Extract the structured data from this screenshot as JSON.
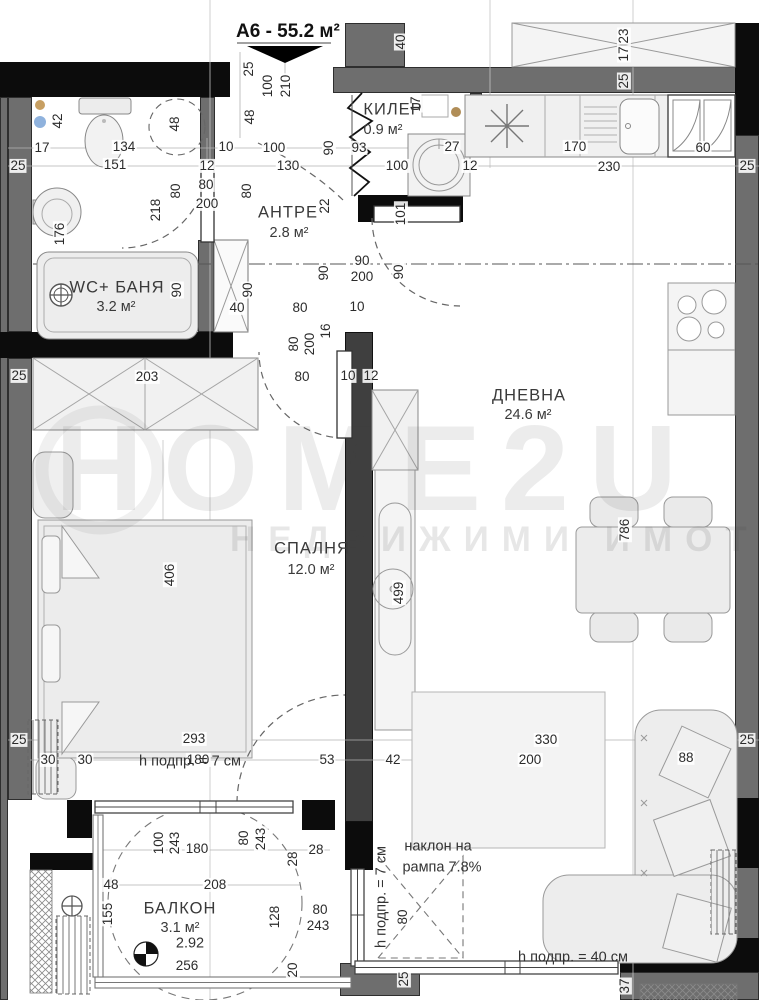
{
  "title": {
    "unit": "А6 - 55.2 м²"
  },
  "watermark": {
    "brand": "HOME2U",
    "tagline": "НЕДВИЖИМИ ИМОТИ"
  },
  "rooms": [
    {
      "name": "КИЛЕР",
      "area": "0.9 м²",
      "x": 393,
      "y": 110,
      "ax": 383,
      "ay": 130
    },
    {
      "name": "АНТРЕ",
      "area": "2.8 м²",
      "x": 288,
      "y": 213,
      "ax": 289,
      "ay": 233
    },
    {
      "name": "WC+ БАНЯ",
      "area": "3.2 м²",
      "x": 117,
      "y": 288,
      "ax": 116,
      "ay": 307
    },
    {
      "name": "ДНЕВНА",
      "area": "24.6 м²",
      "x": 529,
      "y": 396,
      "ax": 528,
      "ay": 415
    },
    {
      "name": "СПАЛНЯ",
      "area": "12.0 м²",
      "x": 312,
      "y": 549,
      "ax": 311,
      "ay": 570
    },
    {
      "name": "БАЛКОН",
      "area": "3.1 м²",
      "x": 180,
      "y": 909,
      "ax": 180,
      "ay": 928
    }
  ],
  "annotations": [
    {
      "t": "h подпр. = 7 см",
      "x": 190,
      "y": 762
    },
    {
      "t": "h подпр. = 7 см",
      "x": 382,
      "y": 897,
      "r": 1
    },
    {
      "t": "наклон на",
      "x": 438,
      "y": 847
    },
    {
      "t": "рампа 7.8%",
      "x": 442,
      "y": 868
    },
    {
      "t": "h подпр. = 40 см",
      "x": 573,
      "y": 958
    },
    {
      "t": "2.92",
      "x": 190,
      "y": 944
    }
  ],
  "dimensions": [
    {
      "t": "25",
      "x": 249,
      "y": 69,
      "r": 1
    },
    {
      "t": "100",
      "x": 268,
      "y": 86,
      "r": 1
    },
    {
      "t": "210",
      "x": 286,
      "y": 86,
      "r": 1
    },
    {
      "t": "48",
      "x": 250,
      "y": 117,
      "r": 1
    },
    {
      "t": "40",
      "x": 401,
      "y": 42,
      "r": 1
    },
    {
      "t": "23",
      "x": 624,
      "y": 36,
      "r": 1
    },
    {
      "t": "17",
      "x": 624,
      "y": 54,
      "r": 1
    },
    {
      "t": "25",
      "x": 624,
      "y": 81,
      "r": 1
    },
    {
      "t": "42",
      "x": 58,
      "y": 121,
      "r": 1
    },
    {
      "t": "17",
      "x": 42,
      "y": 148
    },
    {
      "t": "134",
      "x": 124,
      "y": 147
    },
    {
      "t": "151",
      "x": 115,
      "y": 165
    },
    {
      "t": "48",
      "x": 175,
      "y": 124,
      "r": 1
    },
    {
      "t": "25",
      "x": 18,
      "y": 166
    },
    {
      "t": "10",
      "x": 226,
      "y": 147
    },
    {
      "t": "100",
      "x": 274,
      "y": 148
    },
    {
      "t": "90",
      "x": 329,
      "y": 148,
      "r": 1
    },
    {
      "t": "93",
      "x": 359,
      "y": 148
    },
    {
      "t": "130",
      "x": 288,
      "y": 166
    },
    {
      "t": "100",
      "x": 397,
      "y": 166
    },
    {
      "t": "17",
      "x": 416,
      "y": 104,
      "r": 1
    },
    {
      "t": "27",
      "x": 452,
      "y": 147
    },
    {
      "t": "12",
      "x": 470,
      "y": 166
    },
    {
      "t": "170",
      "x": 575,
      "y": 147
    },
    {
      "t": "230",
      "x": 609,
      "y": 167
    },
    {
      "t": "60",
      "x": 703,
      "y": 148
    },
    {
      "t": "25",
      "x": 747,
      "y": 166
    },
    {
      "t": "80",
      "x": 247,
      "y": 191,
      "r": 1
    },
    {
      "t": "12",
      "x": 207,
      "y": 166
    },
    {
      "t": "80",
      "x": 206,
      "y": 185
    },
    {
      "t": "200",
      "x": 207,
      "y": 204
    },
    {
      "t": "80",
      "x": 176,
      "y": 191,
      "r": 1
    },
    {
      "t": "218",
      "x": 156,
      "y": 210,
      "r": 1
    },
    {
      "t": "176",
      "x": 60,
      "y": 234,
      "r": 1
    },
    {
      "t": "22",
      "x": 325,
      "y": 206,
      "r": 1
    },
    {
      "t": "101",
      "x": 401,
      "y": 214,
      "r": 1
    },
    {
      "t": "90",
      "x": 177,
      "y": 290,
      "r": 1
    },
    {
      "t": "90",
      "x": 248,
      "y": 290,
      "r": 1
    },
    {
      "t": "40",
      "x": 237,
      "y": 308
    },
    {
      "t": "90",
      "x": 324,
      "y": 273,
      "r": 1
    },
    {
      "t": "90",
      "x": 362,
      "y": 261
    },
    {
      "t": "200",
      "x": 362,
      "y": 277
    },
    {
      "t": "90",
      "x": 399,
      "y": 272,
      "r": 1
    },
    {
      "t": "80",
      "x": 300,
      "y": 308
    },
    {
      "t": "10",
      "x": 357,
      "y": 307
    },
    {
      "t": "80",
      "x": 294,
      "y": 344,
      "r": 1
    },
    {
      "t": "200",
      "x": 310,
      "y": 344,
      "r": 1
    },
    {
      "t": "16",
      "x": 326,
      "y": 331,
      "r": 1
    },
    {
      "t": "25",
      "x": 19,
      "y": 376
    },
    {
      "t": "203",
      "x": 147,
      "y": 377
    },
    {
      "t": "80",
      "x": 302,
      "y": 377
    },
    {
      "t": "10",
      "x": 348,
      "y": 376
    },
    {
      "t": "12",
      "x": 371,
      "y": 376
    },
    {
      "t": "406",
      "x": 170,
      "y": 575,
      "r": 1
    },
    {
      "t": "499",
      "x": 399,
      "y": 593,
      "r": 1
    },
    {
      "t": "786",
      "x": 625,
      "y": 530,
      "r": 1
    },
    {
      "t": "25",
      "x": 19,
      "y": 740
    },
    {
      "t": "293",
      "x": 194,
      "y": 739
    },
    {
      "t": "330",
      "x": 546,
      "y": 740
    },
    {
      "t": "25",
      "x": 747,
      "y": 740
    },
    {
      "t": "30",
      "x": 48,
      "y": 760
    },
    {
      "t": "30",
      "x": 85,
      "y": 760
    },
    {
      "t": "180",
      "x": 198,
      "y": 760
    },
    {
      "t": "53",
      "x": 327,
      "y": 760
    },
    {
      "t": "42",
      "x": 393,
      "y": 760
    },
    {
      "t": "200",
      "x": 530,
      "y": 760
    },
    {
      "t": "88",
      "x": 686,
      "y": 758
    },
    {
      "t": "100",
      "x": 159,
      "y": 843,
      "r": 1
    },
    {
      "t": "243",
      "x": 175,
      "y": 843,
      "r": 1
    },
    {
      "t": "180",
      "x": 197,
      "y": 849
    },
    {
      "t": "80",
      "x": 244,
      "y": 838,
      "r": 1
    },
    {
      "t": "243",
      "x": 261,
      "y": 839,
      "r": 1
    },
    {
      "t": "28",
      "x": 293,
      "y": 859,
      "r": 1
    },
    {
      "t": "28",
      "x": 316,
      "y": 850
    },
    {
      "t": "48",
      "x": 111,
      "y": 885
    },
    {
      "t": "208",
      "x": 215,
      "y": 885
    },
    {
      "t": "155",
      "x": 108,
      "y": 914,
      "r": 1
    },
    {
      "t": "128",
      "x": 275,
      "y": 917,
      "r": 1
    },
    {
      "t": "80",
      "x": 320,
      "y": 910
    },
    {
      "t": "243",
      "x": 318,
      "y": 926
    },
    {
      "t": "256",
      "x": 187,
      "y": 966
    },
    {
      "t": "20",
      "x": 293,
      "y": 970,
      "r": 1
    },
    {
      "t": "80",
      "x": 403,
      "y": 917,
      "r": 1
    },
    {
      "t": "25",
      "x": 404,
      "y": 979,
      "r": 1
    },
    {
      "t": "37",
      "x": 625,
      "y": 986,
      "r": 1
    }
  ]
}
